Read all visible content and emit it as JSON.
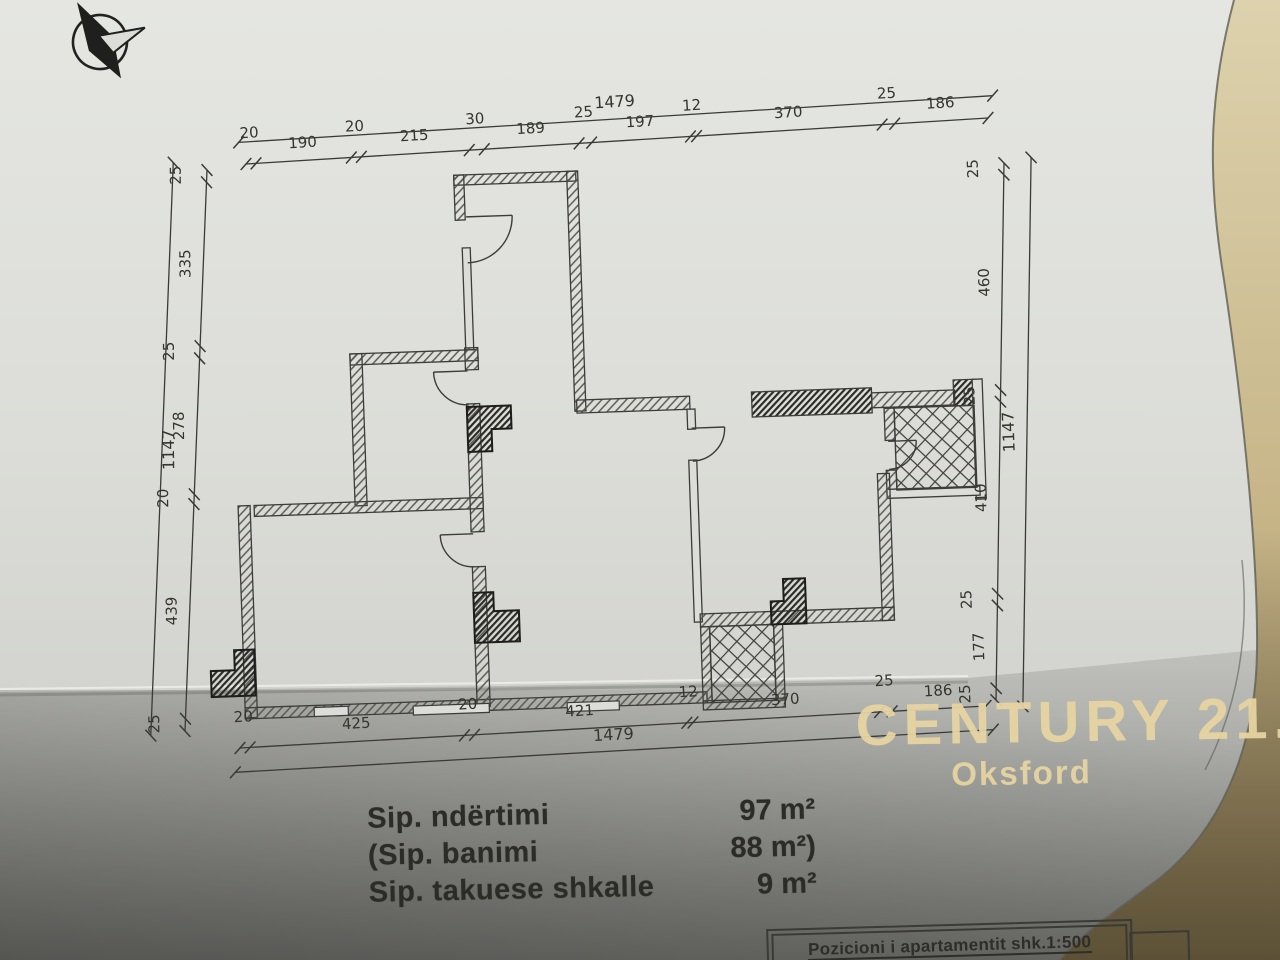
{
  "photo": {
    "watermark": {
      "brand": "CENTURY 21.",
      "office": "Oksford",
      "color": "#e8d5a2"
    },
    "compass_icon": "north-arrow"
  },
  "dimensions": {
    "top": {
      "total": "1479",
      "segments": [
        20,
        190,
        20,
        215,
        30,
        189,
        25,
        197,
        12,
        370,
        25,
        186
      ]
    },
    "bottom": {
      "total": "1479",
      "segments": [
        20,
        425,
        20,
        421,
        12,
        370,
        25,
        186
      ]
    },
    "left": {
      "total": "1147",
      "segments": [
        25,
        335,
        25,
        278,
        20,
        439,
        25
      ]
    },
    "right": {
      "total": "1147",
      "segments": [
        25,
        460,
        25,
        410,
        25,
        177,
        25
      ]
    }
  },
  "areas": {
    "rows": [
      {
        "label": "Sip. ndërtimi",
        "value": "97 m²"
      },
      {
        "label": "(Sip. banimi",
        "value": "88 m²)"
      },
      {
        "label": "Sip. takuese shkalle",
        "value": "9 m²"
      }
    ]
  },
  "title_box": {
    "label": "Pozicioni i apartamentit  shk.1:500"
  },
  "colors": {
    "ink": "#3c3c3a",
    "paper": "#dcddd8",
    "couch": "#c9b88c"
  }
}
